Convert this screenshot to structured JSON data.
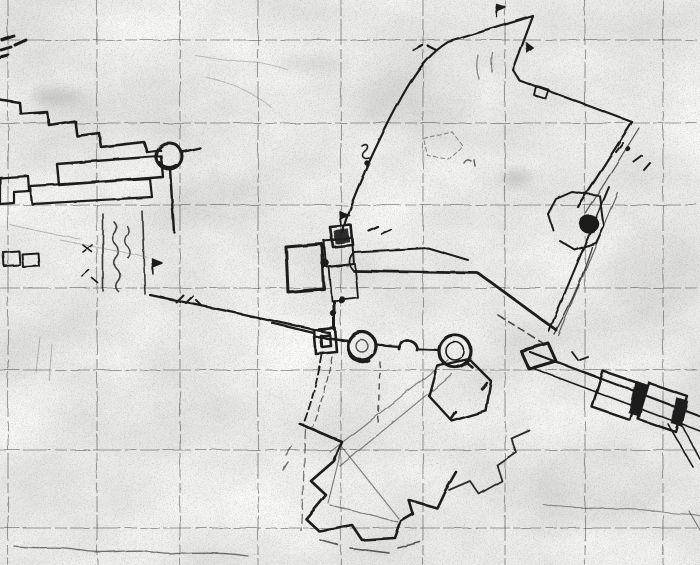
{
  "canvas": {
    "width": 700,
    "height": 565,
    "paper_color": "#efeee9"
  },
  "colors": {
    "ink": "#1b1b1b",
    "grid": "#474747",
    "faint": "#6a6a6a",
    "smudge": "#787672"
  },
  "grid": {
    "vertical_x": [
      8,
      97,
      180,
      258,
      341,
      423,
      505,
      585,
      663
    ],
    "horizontal_y": [
      40,
      123,
      205,
      288,
      370,
      450,
      528
    ]
  },
  "smudges": [
    {
      "cx": 57,
      "cy": 97,
      "rx": 26,
      "ry": 8,
      "op": 0.3
    },
    {
      "cx": 312,
      "cy": 64,
      "rx": 38,
      "ry": 7,
      "op": 0.18
    },
    {
      "cx": 516,
      "cy": 178,
      "rx": 13,
      "ry": 6,
      "op": 0.35
    },
    {
      "cx": 655,
      "cy": 275,
      "rx": 50,
      "ry": 45,
      "op": 0.1
    },
    {
      "cx": 420,
      "cy": 100,
      "rx": 60,
      "ry": 30,
      "op": 0.07
    },
    {
      "cx": 600,
      "cy": 485,
      "rx": 70,
      "ry": 40,
      "op": 0.07
    },
    {
      "cx": 230,
      "cy": 200,
      "rx": 55,
      "ry": 25,
      "op": 0.07
    }
  ],
  "features": [
    {
      "name": "crenellated-wall-left",
      "d": "M0,100 L20,103 L21,114 L47,112 L49,125 L75,121 L77,136 L99,133 L101,147 L144,142 L147,152 L160,150",
      "w": 2.6
    },
    {
      "name": "corner-edge-marks",
      "d": "M2,40 L14,36 M1,50 L11,47 M15,45 L26,40 M0,57 L8,55",
      "w": 3
    },
    {
      "name": "round-tower-left",
      "circle": [
        169,
        156,
        13
      ],
      "w": 3
    },
    {
      "name": "round-tower-left-shade",
      "d": "M159,163 A13,13 0 0 0 176,166",
      "w": 4
    },
    {
      "name": "left-slab-a",
      "d": "M57,164 L161,156 L163,177 L59,185 Z",
      "w": 2.4
    },
    {
      "name": "left-slab-b",
      "d": "M30,186 L150,179 L152,197 L32,204 Z",
      "w": 2.2
    },
    {
      "name": "left-edge-boxes",
      "d": "M0,178 L28,176 L29,191 L14,192 L14,203 L0,204 Z",
      "w": 2.2
    },
    {
      "name": "small-box-row",
      "d": "M3,252 L19,251 L20,265 L4,266 Z M22,254 L38,253 L39,266 L23,267 Z",
      "w": 2
    },
    {
      "name": "courtyard-walls-left",
      "d": "M103,214 L103,291 M142,211 L145,294",
      "w": 1.6,
      "op": 0.85
    },
    {
      "name": "tower-drop-wall",
      "d": "M170,169 L174,232 M182,152 L200,148",
      "w": 2.4
    },
    {
      "name": "handwriting-column-a",
      "d": "M114,222 q5,5 1,11 q-5,6 1,12 q5,6 0,12 q-5,6 1,12 q5,6 0,12 q-4,5 1,10",
      "w": 1.6,
      "op": 0.8
    },
    {
      "name": "handwriting-column-b",
      "d": "M127,226 q4,5 0,10 q-4,6 1,11 q4,6 0,11",
      "w": 1.4,
      "op": 0.8
    },
    {
      "name": "wall-diagonal-to-castle",
      "d": "M150,295 L232,312 L330,333",
      "w": 2.2
    },
    {
      "name": "flag-mark-left-wall",
      "d": "M153,274 L152,259 l10,4 l-10,4 Z",
      "w": 1.5,
      "fill": "ink"
    },
    {
      "name": "marks-left-wall",
      "d": "M176,302 l7,-7 M186,303 l7,-7 M196,300 l6,6",
      "w": 2
    },
    {
      "name": "mark-x-left",
      "d": "M83,245 l9,7 M92,245 l-9,7 M82,276 l7,-6 M92,278 l6,5",
      "w": 1.7
    },
    {
      "name": "terrace-faint-left",
      "d": "M60,240 C95,247 120,252 147,257 M10,225 C40,232 60,236 80,239",
      "w": 1,
      "op": 0.4,
      "color": "faint"
    },
    {
      "name": "castle-tower-block",
      "d": "M330,227 L351,225 L353,245 L333,247 Z",
      "w": 2.6
    },
    {
      "name": "castle-tower-fill",
      "d": "M334,231 L348,229 L350,242 L336,244 Z",
      "w": 0.5,
      "fill": "ink",
      "op": 0.9
    },
    {
      "name": "castle-flag",
      "d": "M341,226 L340,212 l9,3 l-9,4 Z",
      "w": 1.5,
      "fill": "ink"
    },
    {
      "name": "castle-courtyard",
      "d": "M286,247 L322,244 L324,289 L288,292 Z",
      "w": 3
    },
    {
      "name": "castle-keep-upper",
      "d": "M324,241 L352,238 L354,264 L326,267 Z",
      "w": 2
    },
    {
      "name": "castle-keep-lower",
      "d": "M329,267 L355,264 L358,298 L332,301 Z",
      "w": 1.8
    },
    {
      "name": "castle-blob-1",
      "circle": [
        325,
        263,
        4
      ],
      "fill": "ink"
    },
    {
      "name": "castle-blob-2",
      "circle": [
        342,
        300,
        3.5
      ],
      "fill": "ink"
    },
    {
      "name": "castle-blob-3",
      "circle": [
        333,
        313,
        3
      ],
      "fill": "ink"
    },
    {
      "name": "castle-spine",
      "d": "M334,301 L334,329",
      "w": 3
    },
    {
      "name": "gatehouse",
      "d": "M314,330 L335,328 L337,352 L316,354 Z M321,336 L330,335 L331,346 L322,347 Z",
      "w": 2.6
    },
    {
      "name": "wall-west-stub",
      "d": "M272,323 L314,333",
      "w": 2.2
    },
    {
      "name": "north-wall-to-apex",
      "d": "M342,233 C352,195 385,125 408,86 C420,66 432,52 448,42 L533,16",
      "w": 2.2
    },
    {
      "name": "apex-flag",
      "d": "M497,17 L496,4 l9,3 l-9,4 Z",
      "w": 1.5,
      "fill": "ink"
    },
    {
      "name": "apex-mark",
      "d": "M526,42 l8,6 l-7,5 Z",
      "fill": "ink"
    },
    {
      "name": "apex-descent-wall",
      "d": "M533,16 L513,70 L519,80 L632,122",
      "w": 2.2
    },
    {
      "name": "apex-small-box",
      "d": "M536,86 L549,90 L546,99 L534,95 Z",
      "w": 1.8
    },
    {
      "name": "tick-marks-north",
      "d": "M413,50 l9,-5 M428,46 l8,4",
      "w": 2.2
    },
    {
      "name": "hanging-curves-top",
      "d": "M478,55 q-3,12 1,24 M492,52 q-2,10 0,20",
      "w": 1.2,
      "op": 0.5
    },
    {
      "name": "east-wall-outer",
      "d": "M632,122 L578,207",
      "w": 2.2
    },
    {
      "name": "east-wall-inner",
      "d": "M639,128 L586,213",
      "w": 1.2,
      "op": 0.7
    },
    {
      "name": "marks-east-wall",
      "d": "M616,152 l7,-9 M634,162 l8,-6 M644,170 l6,-7",
      "w": 2
    },
    {
      "name": "dot-east-wall",
      "circle": [
        628,
        149,
        2.5
      ],
      "fill": "ink"
    },
    {
      "name": "bastion-walls",
      "d": "M600,196 L572,192 L556,199 L548,214 L553,230 M600,196 L604,226 L596,243 L575,250 L560,241",
      "w": 2
    },
    {
      "name": "bastion-blob",
      "ellipse": [
        589,
        224,
        10,
        9
      ],
      "fill": "ink"
    },
    {
      "name": "bastion-road-outer",
      "d": "M609,187 L549,331",
      "w": 2
    },
    {
      "name": "bastion-road-inner",
      "d": "M618,193 L558,335",
      "w": 1.2,
      "op": 0.65
    },
    {
      "name": "bastion-curve",
      "d": "M592,247 C580,285 567,311 554,334",
      "w": 1.4,
      "op": 0.8
    },
    {
      "name": "road-upper-edge",
      "d": "M354,252 L428,248 L468,260",
      "w": 2
    },
    {
      "name": "road-lower-edge",
      "d": "M354,271 L478,273 L556,330",
      "w": 2.8
    },
    {
      "name": "road-end-curve",
      "d": "M354,252 C348,258 348,266 354,271",
      "w": 1.8
    },
    {
      "name": "road-marks",
      "d": "M369,231 l9,-4 M382,234 l9,-4",
      "w": 2.2
    },
    {
      "name": "dashes-to-pier",
      "d": "M498,315 L549,347",
      "w": 1.6,
      "dash": "7,5",
      "op": 0.8
    },
    {
      "name": "squiggle-annotation",
      "d": "M362,146 c5,-4 8,1 3,5 c-5,4 -2,9 4,7",
      "w": 1.6
    },
    {
      "name": "squiggle-dot",
      "circle": [
        367,
        163,
        2.5
      ],
      "fill": "ink"
    },
    {
      "name": "dashed-polygon-ne",
      "d": "M424,139 L452,132 L463,146 L448,159 L428,156 Z",
      "w": 1.1,
      "dash": "4,3",
      "op": 0.45
    },
    {
      "name": "marks-ci",
      "d": "M464,163 q3,-5 7,-2 M474,160 l1,6",
      "w": 1.4,
      "op": 0.7
    },
    {
      "name": "wall-to-left-tower",
      "d": "M316,337 L348,341",
      "w": 2.4
    },
    {
      "name": "round-tower-gate-left",
      "circle": [
        362,
        346,
        14
      ],
      "w": 3.2
    },
    {
      "name": "round-tower-gate-left-core",
      "circle": [
        362,
        346,
        6
      ],
      "w": 1.4,
      "op": 0.7
    },
    {
      "name": "round-tower-gate-shade",
      "d": "M350,354 A14,14 0 0 0 368,360",
      "w": 4
    },
    {
      "name": "mid-turret",
      "d": "M399,349 A9,9 0 1 1 417,350",
      "w": 2.8
    },
    {
      "name": "curtain-wall-mid",
      "d": "M376,345 L399,347 M417,349 L439,350",
      "w": 2.2
    },
    {
      "name": "round-tower-right",
      "circle": [
        455,
        351,
        16
      ],
      "w": 3.2
    },
    {
      "name": "round-tower-right-core",
      "circle": [
        455,
        351,
        9
      ],
      "w": 1.6
    },
    {
      "name": "hexagon-ravelin",
      "d": "M437,366 L469,359 L491,381 L486,411 L452,421 L429,396 Z",
      "w": 2.4
    },
    {
      "name": "hexagon-corner-marks",
      "d": "M466,362 l6,5 M487,383 l-5,6 M452,418 l4,-6",
      "w": 2.5
    },
    {
      "name": "glacis-diagonals",
      "d": "M330,452 L448,360 M340,466 L452,374",
      "w": 1.2,
      "op": 0.5
    },
    {
      "name": "dash-column-below-tower",
      "d": "M380,362 L378,425",
      "w": 1.5,
      "dash": "5,6",
      "op": 0.7
    },
    {
      "name": "covered-way-outer",
      "d": "M322,355 C317,382 311,404 303,425",
      "w": 1.8,
      "dash": "8,4"
    },
    {
      "name": "covered-way-inner",
      "d": "M332,357 C327,384 321,406 313,427",
      "w": 1.2,
      "dash": "6,4",
      "op": 0.7
    },
    {
      "name": "star-fort-outline",
      "d": "M300,424 L342,442 L334,461 L311,481 L326,495 L306,519 L319,531 L352,525 L362,540 L395,538 L401,521 L413,514 L409,500 L437,508 L445,491 L456,472",
      "w": 2.6
    },
    {
      "name": "star-fort-inner-lines",
      "d": "M342,447 L399,519 M342,447 L328,503 M330,505 L398,522",
      "w": 1.2,
      "op": 0.5
    },
    {
      "name": "star-ne-zigzag",
      "d": "M449,490 L470,481 L479,494 L502,481 L497,465 L516,452 L511,438 L529,430",
      "w": 1.8,
      "op": 0.9
    },
    {
      "name": "covered-way-south",
      "d": "M306,430 L301,531",
      "w": 1.3,
      "dash": "9,5",
      "op": 0.6
    },
    {
      "name": "fort-south-dashes",
      "d": "M350,548 L389,553 M398,548 L420,542 M320,540 L338,545",
      "w": 1.6,
      "op": 0.7
    },
    {
      "name": "fort-west-marks",
      "d": "M292,446 l-6,9 M288,462 l-5,8",
      "w": 1.5,
      "op": 0.6
    },
    {
      "name": "pier-upper-edge",
      "d": "M530,352 L700,416",
      "w": 2.2
    },
    {
      "name": "pier-lower-edge",
      "d": "M527,366 L700,431",
      "w": 1.6
    },
    {
      "name": "pier-head-blob",
      "d": "M521,351 L548,343 L556,361 L529,369 Z",
      "w": 3
    },
    {
      "name": "pier-building-1",
      "d": "M603,371 L641,384 L630,420 L592,407 Z",
      "w": 2.4
    },
    {
      "name": "pier-building-2",
      "d": "M649,383 L687,396 L676,432 L638,419 Z",
      "w": 2.4
    },
    {
      "name": "pier-bar-1",
      "d": "M636,381 L648,385 L640,417 L629,413 Z",
      "fill": "ink"
    },
    {
      "name": "pier-bar-2",
      "d": "M676,397 L688,401 L682,427 L671,423 Z",
      "fill": "ink"
    },
    {
      "name": "pier-tail-lines",
      "d": "M678,418 L700,459 M668,424 L693,467",
      "w": 1.6
    },
    {
      "name": "pier-faint-right",
      "d": "M689,511 L700,530",
      "w": 1.2,
      "op": 0.5
    },
    {
      "name": "marks-near-pier",
      "d": "M572,352 l6,8 M580,360 l8,-3",
      "w": 1.8
    },
    {
      "name": "contour-faint-top",
      "d": "M196,56 C232,62 262,60 288,70 M206,77 C240,85 257,96 272,108",
      "w": 1,
      "op": 0.35,
      "color": "faint"
    },
    {
      "name": "shoreline-bottom-left",
      "d": "M14,546 C40,550 55,545 80,550 C105,555 130,548 155,552 C180,556 210,550 248,556",
      "w": 1.3,
      "op": 0.6
    },
    {
      "name": "shoreline-bottom-right",
      "d": "M543,504 C580,511 625,506 662,512 C680,515 692,513 700,516",
      "w": 1.1,
      "op": 0.45
    },
    {
      "name": "scratch-marks-bottom-left",
      "d": "M40,337 L36,372 M52,345 L49,380",
      "w": 1,
      "op": 0.4,
      "color": "faint"
    }
  ]
}
